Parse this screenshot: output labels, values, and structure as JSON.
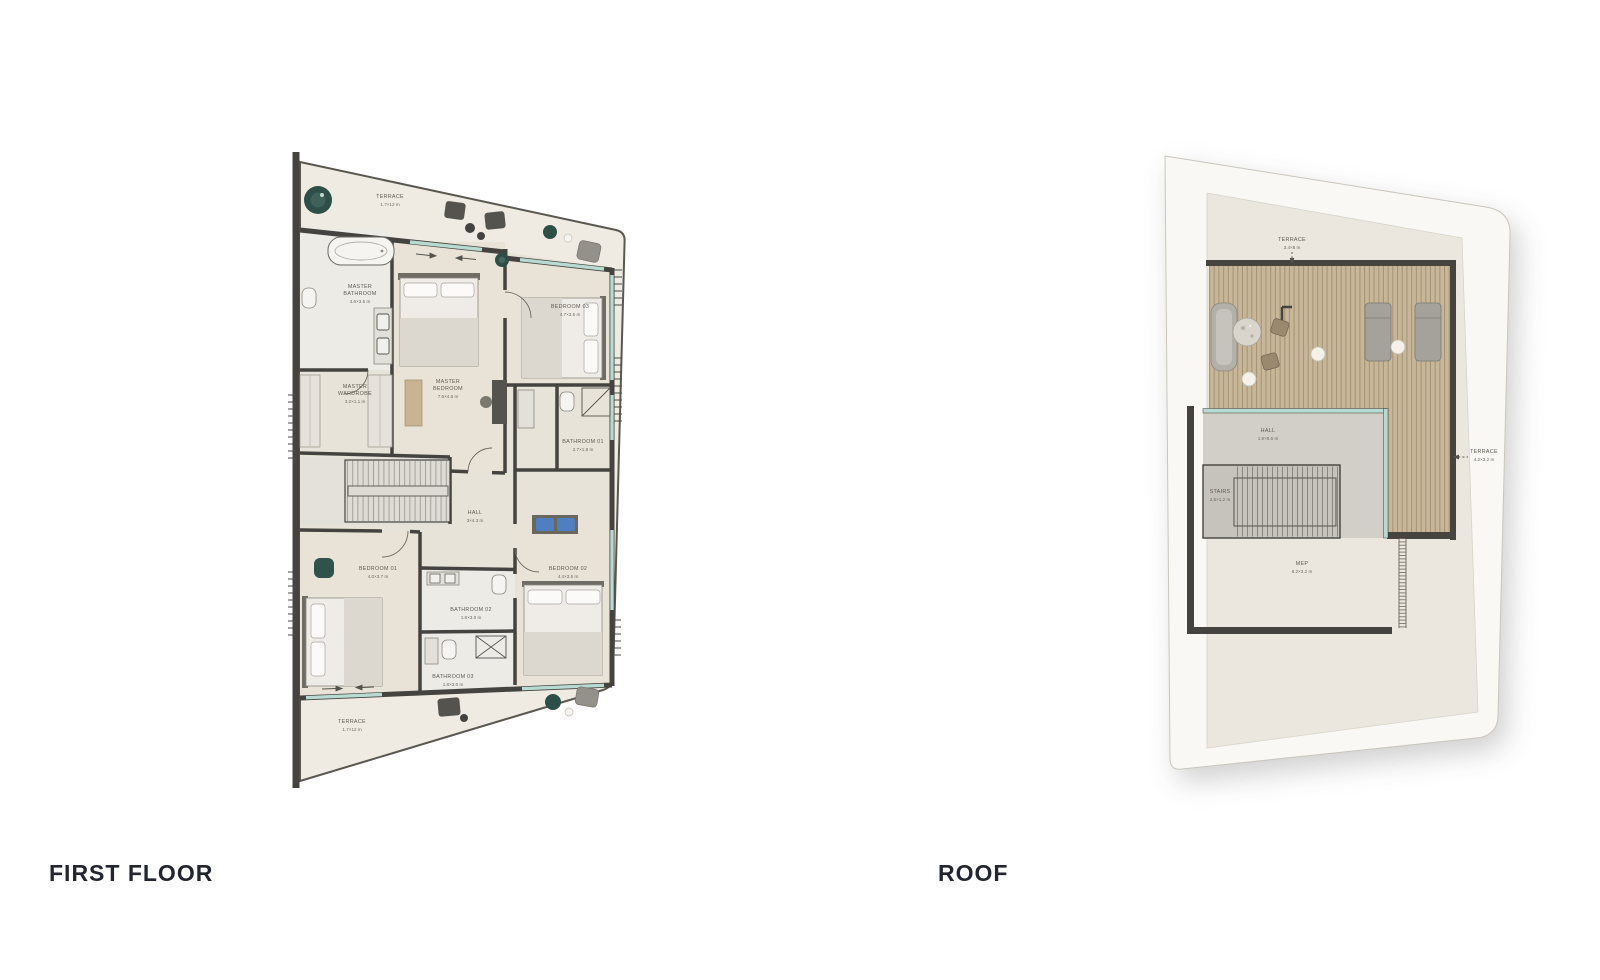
{
  "titles": {
    "first_floor": "FIRST FLOOR",
    "roof": "ROOF"
  },
  "colors": {
    "wall": "#45433f",
    "terrace_floor": "#efebe2",
    "room_floor": "#e8e3d9",
    "glass_window": "#b7dad2",
    "deck_wood": "#c7b698",
    "plant_green": "#2d4f47",
    "bench_blue": "#4f7fc0",
    "title_text": "#23262e",
    "roof_card": "#faf8f4",
    "roof_floor": "#ebe7de"
  },
  "first_floor": {
    "rooms": [
      {
        "id": "terrace-top",
        "lines": [
          "TERRACE",
          "1.7×12 m"
        ]
      },
      {
        "id": "master-bathroom",
        "lines": [
          "MASTER",
          "BATHROOM",
          "4.6×3.5 m"
        ]
      },
      {
        "id": "master-wardrobe",
        "lines": [
          "MASTER",
          "WARDROBE",
          "3.2×1.1 m"
        ]
      },
      {
        "id": "master-bedroom",
        "lines": [
          "MASTER",
          "BEDROOM",
          "7.6×4.6 m"
        ]
      },
      {
        "id": "bedroom-03",
        "lines": [
          "BEDROOM 03",
          "4.7×3.5 m"
        ]
      },
      {
        "id": "bathroom-01",
        "lines": [
          "BATHROOM 01",
          "2.7×1.8 m"
        ]
      },
      {
        "id": "hall",
        "lines": [
          "HALL",
          "3×4.3 m"
        ]
      },
      {
        "id": "bedroom-01",
        "lines": [
          "BEDROOM 01",
          "4.0×3.7 m"
        ]
      },
      {
        "id": "bedroom-02",
        "lines": [
          "BEDROOM 02",
          "4.4×3.5 m"
        ]
      },
      {
        "id": "bathroom-02",
        "lines": [
          "BATHROOM 02",
          "1.8×3.0 m"
        ]
      },
      {
        "id": "bathroom-03",
        "lines": [
          "BATHROOM 03",
          "1.8×3.0 m"
        ]
      },
      {
        "id": "terrace-bottom",
        "lines": [
          "TERRACE",
          "1.7×12 m"
        ]
      }
    ]
  },
  "roof": {
    "rooms": [
      {
        "id": "terrace-top",
        "lines": [
          "TERRACE",
          "3.4×8 m"
        ]
      },
      {
        "id": "hall",
        "lines": [
          "HALL",
          "1.9×8.6 m"
        ]
      },
      {
        "id": "stairs",
        "lines": [
          "STAIRS",
          "2.5×1.2 m"
        ]
      },
      {
        "id": "terrace-side",
        "lines": [
          "TERRACE",
          "4.2×3.2 m"
        ]
      },
      {
        "id": "mep",
        "lines": [
          "MEP",
          "8.2×3.2 m"
        ]
      }
    ]
  }
}
